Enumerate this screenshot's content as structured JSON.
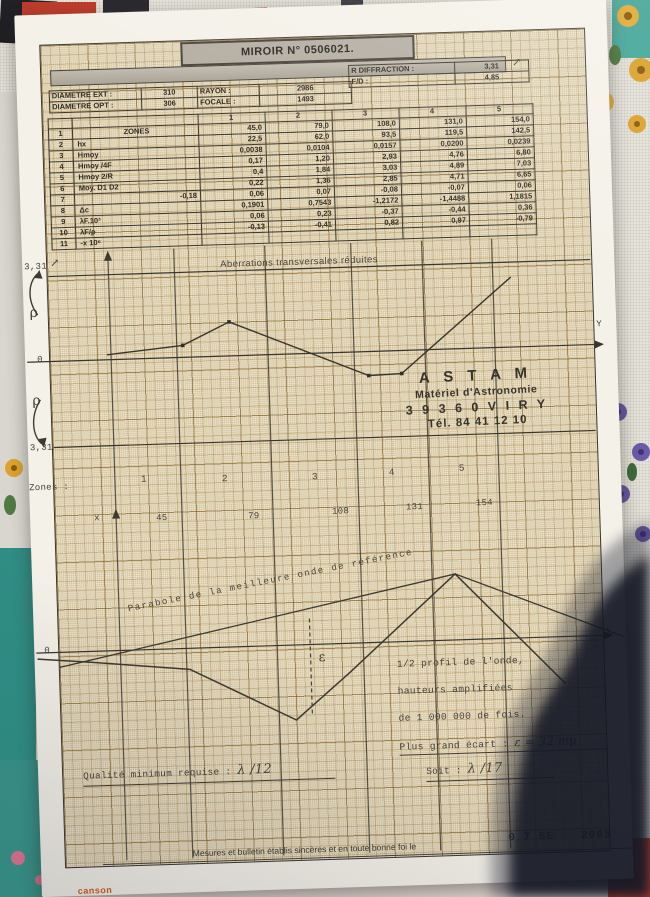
{
  "document": {
    "title": "MIROIR N° 0506021.",
    "brand_logo": "canson",
    "stamp": {
      "line1": "A S T A M",
      "line2": "Matériel d'Astronomie",
      "line3": "3 9 3 6 0   V I R Y",
      "line4": "Tél. 84 41 12 10"
    },
    "date_stamp_left": "0 7 SE",
    "date_stamp_right": "2005",
    "certify_line": "Mesures et bulletin établis sincères et en toute bonne foi le",
    "quality_label": "Qualité minimum requise :",
    "quality_value": "λ /12",
    "soit_label": "Soit :",
    "soit_value": "λ /17"
  },
  "header_table": {
    "rows": [
      [
        "DIAMETRE EXT :",
        "310",
        "RAYON :",
        "2986"
      ],
      [
        "DIAMETRE OPT :",
        "306",
        "FOCALE :",
        "1493"
      ]
    ]
  },
  "diffraction_table": {
    "rows": [
      [
        "R DIFFRACTION :",
        "3,31"
      ],
      [
        "F/D :",
        "4,85"
      ]
    ]
  },
  "zones_table": {
    "rows": [
      [
        "",
        "",
        "1",
        "2",
        "3",
        "4",
        "5"
      ],
      [
        "1",
        "ZONES",
        "45,0",
        "79,0",
        "108,0",
        "131,0",
        "154,0"
      ],
      [
        "2",
        "hx",
        "22,5",
        "62,0",
        "93,5",
        "119,5",
        "142,5"
      ],
      [
        "3",
        "Hmoy",
        "0,0038",
        "0,0104",
        "0,0157",
        "0,0200",
        "0,0239"
      ],
      [
        "4",
        "Hmoy /4F",
        "0,17",
        "1,20",
        "2,93",
        "4,76",
        "6,80"
      ],
      [
        "5",
        "Hmoy 2/R",
        "0,4",
        "1,84",
        "3,03",
        "4,89",
        "7,03"
      ],
      [
        "6",
        "Moy. D1 D2",
        "0,22",
        "1,36",
        "2,85",
        "4,71",
        "6,65"
      ],
      [
        "7",
        "-0,18",
        "0,06",
        "0,07",
        "-0,08",
        "-0,07",
        "0,06"
      ],
      [
        "8",
        "Δc",
        "0,1901",
        "0,7543",
        "-1,2172",
        "-1,4488",
        "1,1815"
      ],
      [
        "9",
        "λF.10³",
        "0,06",
        "0,23",
        "-0,37",
        "-0,44",
        "0,36"
      ],
      [
        "10",
        "λF/ρ",
        "-0,13",
        "-0,41",
        "0,82",
        "0,97",
        "-0,79"
      ],
      [
        "11",
        "-x 10⁶",
        "",
        "",
        "",
        "",
        ""
      ]
    ]
  },
  "axes": {
    "top_331": "3,31",
    "rho": "ρ",
    "zero": "0",
    "bottom_331": "3,31",
    "y_label": "Y",
    "x_label": "x",
    "zones_label": "Zones :",
    "pen_arrow": "↗",
    "zone_numbers": [
      "1",
      "2",
      "3",
      "4",
      "5"
    ],
    "zone_radii": [
      "45",
      "79",
      "108",
      "131",
      "154"
    ]
  },
  "annotations": {
    "parabole_label": "Parabole de la meilleure onde de référence",
    "epsilon_symbol": "ε",
    "profile_note_1": "1/2 profil de l'onde,",
    "profile_note_2": "hauteurs amplifiées",
    "profile_note_3": "de 1 000 000 de fois.",
    "ecart_label": "Plus grand écart :",
    "ecart_value": "ε = 32 mμ"
  },
  "chart_data": [
    {
      "type": "line",
      "title": "Aberrations transversales réduites",
      "xlabel": "x (rayon de zone, mm)",
      "x": [
        22.5,
        62.0,
        93.5,
        119.5,
        142.5
      ],
      "zone_boundaries": [
        45,
        79,
        108,
        131,
        154
      ],
      "series": [
        {
          "name": "aberration transversale réduite Δc",
          "values": [
            0.19,
            0.75,
            -1.22,
            -1.45,
            1.18
          ]
        }
      ],
      "ylim": [
        -3.31,
        3.31
      ],
      "y_ticks": [
        "+3,31",
        "+ρ",
        "0",
        "-ρ",
        "-3,31"
      ],
      "points_px": [
        [
          82,
          112
        ],
        [
          158,
          105
        ],
        [
          205,
          83
        ],
        [
          343,
          141
        ],
        [
          376,
          140
        ],
        [
          488,
          47
        ]
      ],
      "dots_px": [
        [
          158,
          105
        ],
        [
          205,
          83
        ],
        [
          343,
          141
        ],
        [
          376,
          140
        ]
      ]
    },
    {
      "type": "line",
      "title": "1/2 profil de l'onde, hauteurs amplifiées de 1 000 000 de fois",
      "note": "Plus grand écart : ε = 32 mμ ; qualité minimum requise λ/12 ; soit λ/17",
      "series": [
        {
          "name": "Parabole de la meilleure onde de référence",
          "points_px": [
            [
              25,
              93
            ],
            [
              423,
              12
            ],
            [
              590,
              80
            ]
          ]
        },
        {
          "name": "1/2 profil de l'onde mesuré",
          "points_px": [
            [
              3,
              84
            ],
            [
              58,
              89
            ],
            [
              155,
              99
            ],
            [
              260,
              153
            ],
            [
              315,
              107
            ],
            [
              423,
              12
            ],
            [
              530,
              125
            ]
          ]
        }
      ],
      "epsilon_px": {
        "x": 276,
        "y1": 52,
        "y2": 147
      }
    }
  ]
}
